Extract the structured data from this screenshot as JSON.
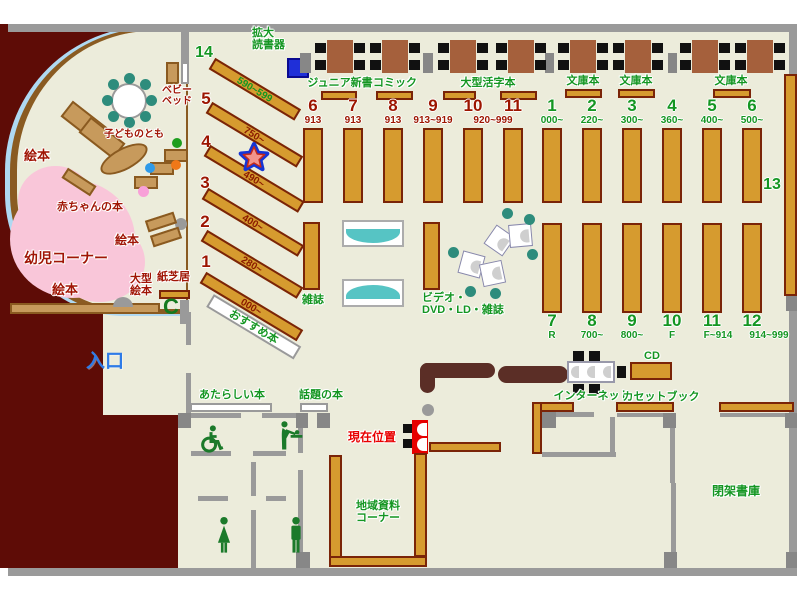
{
  "labels": {
    "reader_machine": "拡大\n読書器",
    "junior_shinsho": "ジュニア新書",
    "comic": "コミック",
    "large_print": "大型活字本",
    "bunko": "文庫本",
    "zasshi": "雑誌",
    "video_corner": "ビデオ・\nDVD・LD・雑誌",
    "osusume": "おすすめ本",
    "thirteen": "13",
    "baby_bed": "ベビー\nベッド",
    "kodomo_no_tomo": "子どものとも",
    "ehon": "絵本",
    "akachan_books": "赤ちゃんの本",
    "yoji_corner": "幼児コーナー",
    "ogata_ehon": "大型\n絵本",
    "kamishibai": "紙芝居",
    "entrance": "入口",
    "new_books": "あたらしい本",
    "topic_books": "話題の本",
    "current_location": "現在位置",
    "cd": "CD",
    "internet": "インターネット",
    "cassette_book": "カセットブック",
    "local_materials": "地域資料\nコーナー",
    "closed_stacks": "閉架書庫",
    "phone": "C"
  },
  "nonfiction_row": [
    {
      "num": "6",
      "range": "913"
    },
    {
      "num": "7",
      "range": "913"
    },
    {
      "num": "8",
      "range": "913"
    },
    {
      "num": "9",
      "range": "913~919"
    },
    {
      "num": "10",
      "range": "920~999"
    },
    {
      "num": "11",
      "range": ""
    }
  ],
  "fiction_row": [
    {
      "num": "1",
      "range": "000~"
    },
    {
      "num": "2",
      "range": "220~"
    },
    {
      "num": "3",
      "range": "300~"
    },
    {
      "num": "4",
      "range": "360~"
    },
    {
      "num": "5",
      "range": "400~"
    },
    {
      "num": "6",
      "range": "500~"
    }
  ],
  "south_row": [
    {
      "num": "7",
      "range": "R"
    },
    {
      "num": "8",
      "range": "700~"
    },
    {
      "num": "9",
      "range": "800~"
    },
    {
      "num": "10",
      "range": "F"
    },
    {
      "num": "11",
      "range": "F~914"
    },
    {
      "num": "12",
      "range": "914~999"
    }
  ],
  "diagonal_row": [
    {
      "num": "14",
      "range": "590~599"
    },
    {
      "num": "5",
      "range": "750~"
    },
    {
      "num": "4",
      "range": "490~"
    },
    {
      "num": "3",
      "range": "400~"
    },
    {
      "num": "2",
      "range": "280~"
    },
    {
      "num": "1",
      "range": "000~"
    }
  ],
  "colors": {
    "floor": "#ECECDB",
    "exterior": "#5E0C06",
    "shelf": "#D69B2F",
    "green_text": "#149622",
    "red_text": "#A01505",
    "entrance_blue": "#2E7BE8",
    "marker_red": "#E60000"
  }
}
